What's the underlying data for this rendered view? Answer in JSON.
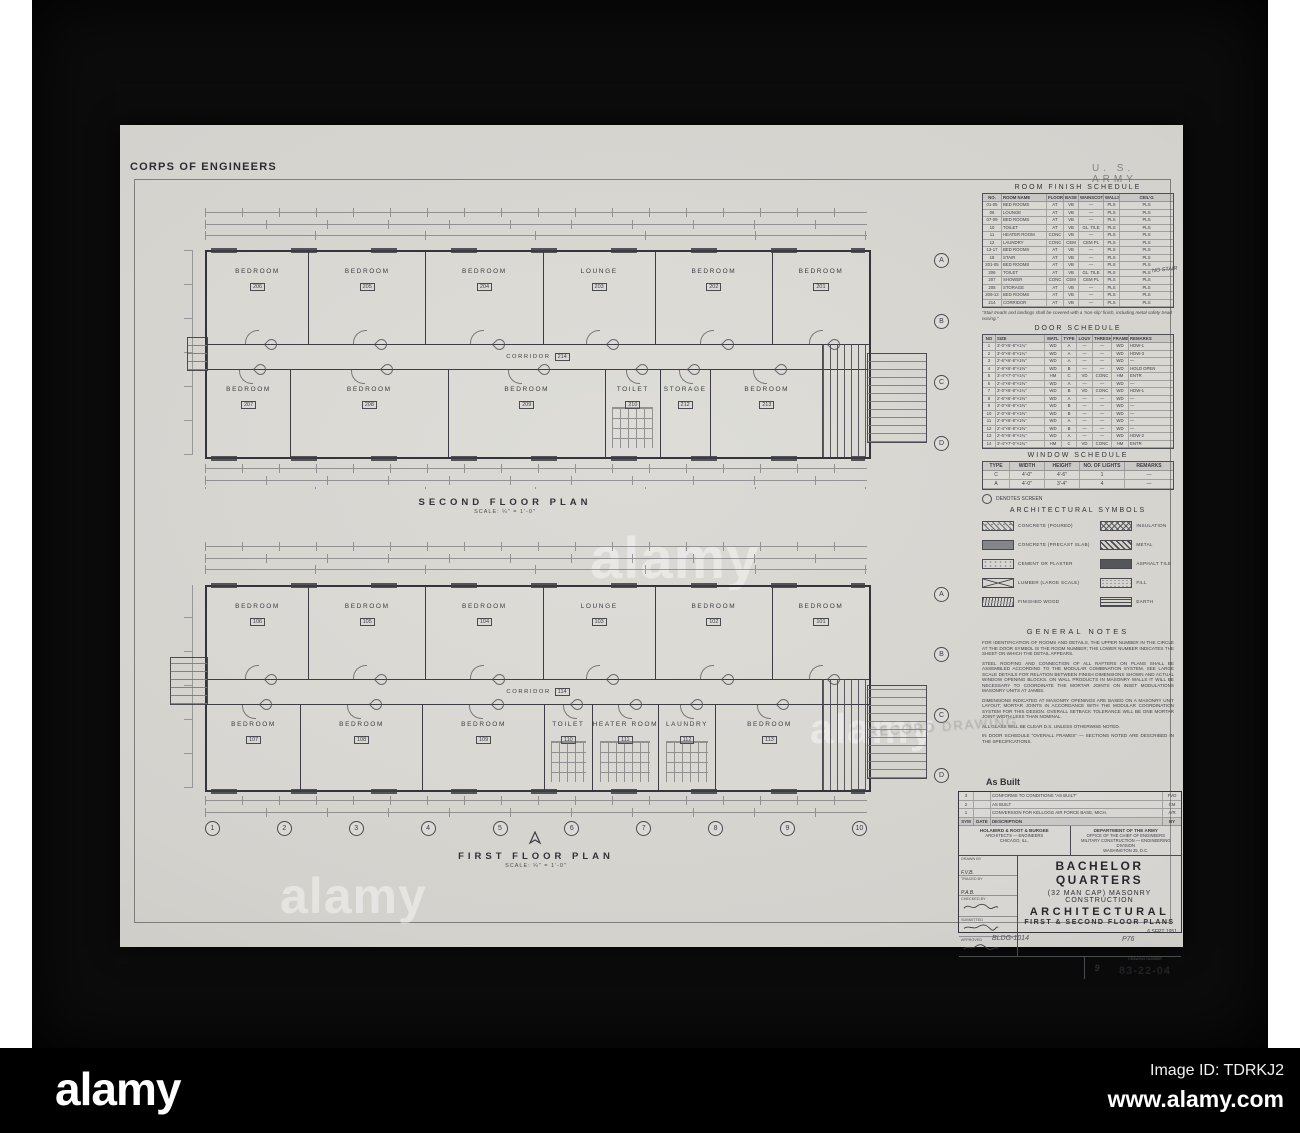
{
  "header": {
    "left": "CORPS OF ENGINEERS",
    "right": "U. S. ARMY"
  },
  "plans": {
    "second": {
      "caption": "SECOND FLOOR PLAN",
      "scale": "SCALE: ¼″ = 1′-0″",
      "corridor": {
        "name": "CORRIDOR",
        "number": "214"
      },
      "top_rooms": [
        {
          "name": "BEDROOM",
          "number": "206",
          "flex": "1"
        },
        {
          "name": "BEDROOM",
          "number": "205",
          "flex": "1.15"
        },
        {
          "name": "BEDROOM",
          "number": "204",
          "flex": "1.15"
        },
        {
          "name": "LOUNGE",
          "number": "203",
          "flex": "1.1"
        },
        {
          "name": "BEDROOM",
          "number": "202",
          "flex": "1.15"
        },
        {
          "name": "BEDROOM",
          "number": "201",
          "flex": "0.95"
        }
      ],
      "bottom_rooms": [
        {
          "name": "BEDROOM",
          "number": "207",
          "flex": "0.85"
        },
        {
          "name": "BEDROOM",
          "number": "208",
          "flex": "1.6"
        },
        {
          "name": "BEDROOM",
          "number": "209",
          "flex": "1.6"
        },
        {
          "name": "TOILET",
          "number": "210",
          "flex": "0.55",
          "cls": "has-fix"
        },
        {
          "name": "STORAGE",
          "number": "212",
          "flex": "0.5"
        },
        {
          "name": "BEDROOM",
          "number": "213",
          "flex": "1.15"
        }
      ]
    },
    "first": {
      "caption": "FIRST FLOOR PLAN",
      "scale": "SCALE: ¼″ = 1′-0″",
      "corridor": {
        "name": "CORRIDOR",
        "number": "114"
      },
      "top_rooms": [
        {
          "name": "BEDROOM",
          "number": "106",
          "flex": "1"
        },
        {
          "name": "BEDROOM",
          "number": "105",
          "flex": "1.15"
        },
        {
          "name": "BEDROOM",
          "number": "104",
          "flex": "1.15"
        },
        {
          "name": "LOUNGE",
          "number": "103",
          "flex": "1.1"
        },
        {
          "name": "BEDROOM",
          "number": "102",
          "flex": "1.15"
        },
        {
          "name": "BEDROOM",
          "number": "101",
          "flex": "0.95"
        }
      ],
      "bottom_rooms": [
        {
          "name": "BEDROOM",
          "number": "107",
          "flex": "1"
        },
        {
          "name": "BEDROOM",
          "number": "108",
          "flex": "1.3"
        },
        {
          "name": "BEDROOM",
          "number": "109",
          "flex": "1.3"
        },
        {
          "name": "TOILET",
          "number": "110",
          "flex": "0.5",
          "cls": "has-fix"
        },
        {
          "name": "HEATER ROOM",
          "number": "111",
          "flex": "0.55",
          "cls": "has-fix"
        },
        {
          "name": "LAUNDRY",
          "number": "112",
          "flex": "0.6",
          "cls": "has-fix"
        },
        {
          "name": "BEDROOM",
          "number": "113",
          "flex": "1.15"
        }
      ]
    }
  },
  "grid": {
    "letters": [
      "A",
      "B",
      "C",
      "D"
    ],
    "numbers": [
      "1",
      "2",
      "3",
      "4",
      "5",
      "6",
      "7",
      "8",
      "9",
      "10"
    ]
  },
  "schedules": {
    "room_finish": {
      "title": "ROOM FINISH SCHEDULE",
      "columns": {
        "c0": "NO.",
        "c1": "ROOM NAME",
        "c2": "FLOOR",
        "c3": "BASE",
        "c4": "WAINSCOT",
        "c5": "WALLS",
        "c6": "CEIL’G"
      },
      "rows": [
        {
          "c0": "01-05",
          "c1": "BED ROOMS",
          "c2": "AT",
          "c3": "VB",
          "c4": "—",
          "c5": "PLS",
          "c6": "PLS"
        },
        {
          "c0": "06",
          "c1": "LOUNGE",
          "c2": "AT",
          "c3": "VB",
          "c4": "—",
          "c5": "PLS",
          "c6": "PLS"
        },
        {
          "c0": "07-09",
          "c1": "BED ROOMS",
          "c2": "AT",
          "c3": "VB",
          "c4": "—",
          "c5": "PLS",
          "c6": "PLS"
        },
        {
          "c0": "10",
          "c1": "TOILET",
          "c2": "AT",
          "c3": "VB",
          "c4": "GL. TILE",
          "c5": "PLS",
          "c6": "PLS"
        },
        {
          "c0": "11",
          "c1": "HEATER ROOM",
          "c2": "CONC",
          "c3": "VB",
          "c4": "—",
          "c5": "PLS",
          "c6": "PLS"
        },
        {
          "c0": "12",
          "c1": "LAUNDRY",
          "c2": "CONC",
          "c3": "CEM",
          "c4": "CEM PL",
          "c5": "PLS",
          "c6": "PLS"
        },
        {
          "c0": "13-17",
          "c1": "BED ROOMS",
          "c2": "AT",
          "c3": "VB",
          "c4": "—",
          "c5": "PLS",
          "c6": "PLS"
        },
        {
          "c0": "18",
          "c1": "STAIR",
          "c2": "AT",
          "c3": "VB",
          "c4": "—",
          "c5": "PLS",
          "c6": "PLS"
        },
        {
          "c0": "201-05",
          "c1": "BED ROOMS",
          "c2": "AT",
          "c3": "VB",
          "c4": "—",
          "c5": "PLS",
          "c6": "PLS"
        },
        {
          "c0": "206",
          "c1": "TOILET",
          "c2": "AT",
          "c3": "VB",
          "c4": "GL. TILE",
          "c5": "PLS",
          "c6": "PLS"
        },
        {
          "c0": "207",
          "c1": "SHOWER",
          "c2": "CONC",
          "c3": "CEM",
          "c4": "CEM PL",
          "c5": "PLS",
          "c6": "PLS"
        },
        {
          "c0": "208",
          "c1": "STORAGE",
          "c2": "AT",
          "c3": "VB",
          "c4": "—",
          "c5": "PLS",
          "c6": "PLS"
        },
        {
          "c0": "209-13",
          "c1": "BED ROOMS",
          "c2": "AT",
          "c3": "VB",
          "c4": "—",
          "c5": "PLS",
          "c6": "PLS"
        },
        {
          "c0": "214",
          "c1": "CORRIDOR",
          "c2": "AT",
          "c3": "VB",
          "c4": "—",
          "c5": "PLS",
          "c6": "PLS"
        }
      ],
      "footnote": "“Stair treads and landings shall be covered with a ‘non-slip’ finish, including metal safety tread nosing.”",
      "side_note": "NO STAIR"
    },
    "door": {
      "title": "DOOR SCHEDULE",
      "columns": {
        "c0": "NO",
        "c1": "SIZE",
        "c2": "MATL",
        "c3": "TYPE",
        "c4": "LOUV",
        "c5": "THRESH",
        "c6": "FRAME",
        "c7": "REMARKS"
      },
      "rows": [
        {
          "c0": "1",
          "c1": "3′-0″×6′-8″×1¾″",
          "c2": "WD",
          "c3": "A",
          "c4": "—",
          "c5": "—",
          "c6": "WD",
          "c7": "HDW-1"
        },
        {
          "c0": "2",
          "c1": "3′-0″×6′-8″×1¾″",
          "c2": "WD",
          "c3": "A",
          "c4": "—",
          "c5": "—",
          "c6": "WD",
          "c7": "HDW-3"
        },
        {
          "c0": "3",
          "c1": "2′-6″×6′-8″×1⅜″",
          "c2": "WD",
          "c3": "A",
          "c4": "—",
          "c5": "—",
          "c6": "WD",
          "c7": "—"
        },
        {
          "c0": "4",
          "c1": "2′-6″×6′-8″×1⅜″",
          "c2": "WD",
          "c3": "B",
          "c4": "—",
          "c5": "—",
          "c6": "WD",
          "c7": "HOLD OPEN"
        },
        {
          "c0": "5",
          "c1": "3′-4″×7′-0″×1¾″",
          "c2": "HM",
          "c3": "C",
          "c4": "VD",
          "c5": "CONC",
          "c6": "HM",
          "c7": "ENTR"
        },
        {
          "c0": "6",
          "c1": "2′-4″×6′-8″×1⅜″",
          "c2": "WD",
          "c3": "A",
          "c4": "—",
          "c5": "—",
          "c6": "WD",
          "c7": "—"
        },
        {
          "c0": "7",
          "c1": "3′-0″×6′-8″×1¾″",
          "c2": "WD",
          "c3": "B",
          "c4": "VD",
          "c5": "CONC",
          "c6": "WD",
          "c7": "HDW-1"
        },
        {
          "c0": "8",
          "c1": "2′-6″×6′-8″×1⅜″",
          "c2": "WD",
          "c3": "A",
          "c4": "—",
          "c5": "—",
          "c6": "WD",
          "c7": "—"
        },
        {
          "c0": "9",
          "c1": "2′-0″×6′-8″×1⅜″",
          "c2": "WD",
          "c3": "B",
          "c4": "—",
          "c5": "—",
          "c6": "WD",
          "c7": "—"
        },
        {
          "c0": "10",
          "c1": "2′-0″×6′-8″×1⅜″",
          "c2": "WD",
          "c3": "B",
          "c4": "—",
          "c5": "—",
          "c6": "WD",
          "c7": "—"
        },
        {
          "c0": "11",
          "c1": "2′-8″×6′-8″×1⅜″",
          "c2": "WD",
          "c3": "A",
          "c4": "—",
          "c5": "—",
          "c6": "WD",
          "c7": "—"
        },
        {
          "c0": "12",
          "c1": "2′-4″×6′-8″×1⅜″",
          "c2": "WD",
          "c3": "B",
          "c4": "—",
          "c5": "—",
          "c6": "WD",
          "c7": "—"
        },
        {
          "c0": "13",
          "c1": "2′-6″×6′-8″×1¾″",
          "c2": "WD",
          "c3": "A",
          "c4": "—",
          "c5": "—",
          "c6": "WD",
          "c7": "HDW-2"
        },
        {
          "c0": "14",
          "c1": "3′-4″×7′-0″×1¾″",
          "c2": "HM",
          "c3": "C",
          "c4": "VD",
          "c5": "CONC",
          "c6": "HM",
          "c7": "ENTR"
        }
      ]
    },
    "window": {
      "title": "WINDOW SCHEDULE",
      "columns": {
        "c0": "TYPE",
        "c1": "WIDTH",
        "c2": "HEIGHT",
        "c3": "NO. OF LIGHTS",
        "c4": "REMARKS"
      },
      "rows": [
        {
          "c0": "C",
          "c1": "4′-0″",
          "c2": "4′-6″",
          "c3": "1",
          "c4": "—"
        },
        {
          "c0": "A",
          "c1": "4′-0″",
          "c2": "3′-4″",
          "c3": "4",
          "c4": "—"
        }
      ]
    },
    "screen_note": "DENOTES SCREEN"
  },
  "symbols": {
    "title": "ARCHITECTURAL SYMBOLS",
    "items": [
      {
        "label": "CONCRETE (POURED)",
        "cls": "sw-conc"
      },
      {
        "label": "CONCRETE (PRECAST SLAB)",
        "cls": "sw-precast"
      },
      {
        "label": "CEMENT OR PLASTER",
        "cls": "sw-plaster"
      },
      {
        "label": "LUMBER (LARGE SCALE)",
        "cls": "sw-lumber"
      },
      {
        "label": "FINISHED WOOD",
        "cls": "sw-wood"
      },
      {
        "label": "INSULATION",
        "cls": "sw-insul"
      },
      {
        "label": "METAL",
        "cls": "sw-metal"
      },
      {
        "label": "ASPHALT TILE",
        "cls": "sw-asphalt"
      },
      {
        "label": "FILL",
        "cls": "sw-fill"
      },
      {
        "label": "EARTH",
        "cls": "sw-earth"
      }
    ]
  },
  "general_notes": {
    "title": "GENERAL NOTES",
    "paragraphs": [
      "FOR IDENTIFICATION OF ROOMS AND DETAILS, THE UPPER NUMBER IN THE CIRCLE AT THE DOOR SYMBOL IS THE ROOM NUMBER; THE LOWER NUMBER INDICATES THE SHEET ON WHICH THE DETAIL APPEARS.",
      "STEEL ROOFING AND CONNECTION OF ALL RAFTERS ON PLANS SHALL BE ASSEMBLED ACCORDING TO THE MODULAR COMBINATION SYSTEM. SEE LARGE SCALE DETAILS FOR RELATION BETWEEN FINISH DIMENSIONS SHOWN AND ACTUAL WINDOW OPENING BLOCKS. ON WALL PRODUCTS IN MASONRY WALLS IT WILL BE NECESSARY TO COORDINATE THE MORTAR JOINTS ON INSET MODULATIONS MASONRY UNITS AT JAMBS.",
      "DIMENSIONS INDICATED AT MASONRY OPENINGS ARE BASED ON A MASONRY UNIT LAYOUT; MORTAR JOINTS IN ACCORDANCE WITH THE MODULAR COORDINATION SYSTEM FOR THIS DESIGN. OVERALL SETBACK TOLERANCE WILL BE ONE MORTAR JOINT WIDTH LESS THAN NOMINAL.",
      "ALL GLASS WILL BE CLEAR D.S. UNLESS OTHERWISE NOTED.",
      "IN DOOR SCHEDULE “OVERALL FRAMES” — SECTIONS NOTED ARE DESCRIBED IN THE SPECIFICATIONS."
    ]
  },
  "stamps": {
    "record": "RECORD DRAWING",
    "as_built": "As Built"
  },
  "title_block": {
    "rev_header": {
      "sym": "SYM",
      "date": "DATE",
      "desc": "DESCRIPTION",
      "by": "BY"
    },
    "revisions": [
      {
        "sym": "3",
        "date": "",
        "desc": "CONFORMS TO CONDITIONS “AS BUILT”",
        "by": "FVD"
      },
      {
        "sym": "2",
        "date": "",
        "desc": "AS BUILT",
        "by": "CM"
      },
      {
        "sym": "1",
        "date": "",
        "desc": "CONVERSION FOR KELLOGG AIR FORCE BASE, MICH.",
        "by": "A/R"
      }
    ],
    "firm": [
      "HOLABIRD & ROOT & BURGEE",
      "ARCHITECTS — ENGINEERS",
      "CHICAGO, ILL."
    ],
    "agency": [
      "DEPARTMENT OF THE ARMY",
      "OFFICE OF THE CHIEF OF ENGINEERS",
      "MILITARY CONSTRUCTION — ENGINEERING DIVISION",
      "WASHINGTON 25, D.C."
    ],
    "stubs": {
      "drawn_label": "DRAWN BY",
      "drawn_val": "F.V.B.",
      "traced_label": "TRACED BY",
      "traced_val": "P.A.B.",
      "checked_label": "CHECKED BY",
      "submitted_label": "SUBMITTED",
      "approved_label": "APPROVED"
    },
    "project": "BACHELOR QUARTERS",
    "subtitle": "(32 MAN CAP) MASONRY CONSTRUCTION",
    "discipline": "ARCHITECTURAL",
    "sheet_title": "FIRST & SECOND FLOOR PLANS",
    "date": "6 SEPT 1951",
    "drawing_number_label": "DRAWING NUMBER",
    "drawing_number": "83-22-04",
    "sheet_no": "9",
    "handwritten_1": "BLDG-1014",
    "handwritten_2": "P76"
  },
  "watermark": {
    "logo": "alamy",
    "image_id": "Image ID: TDRKJ2",
    "url": "www.alamy.com"
  }
}
